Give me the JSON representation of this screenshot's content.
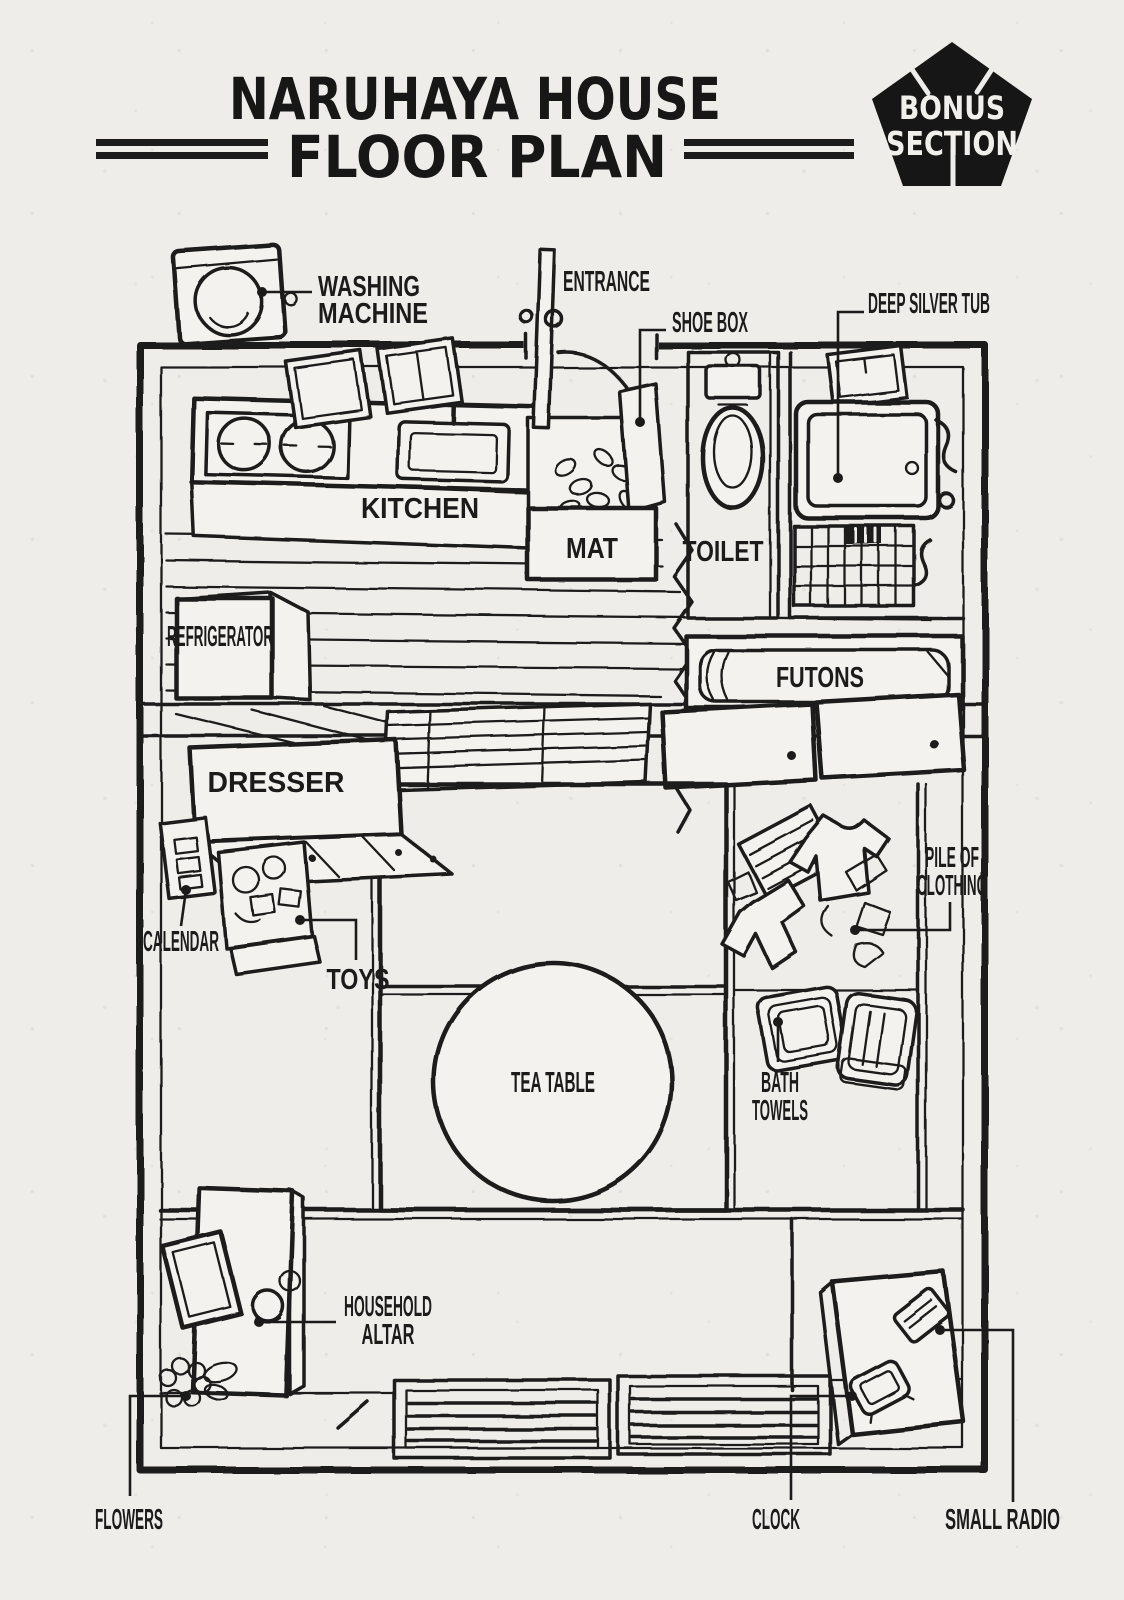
{
  "header": {
    "title_line1": "NARUHAYA HOUSE",
    "title_line2": "FLOOR PLAN"
  },
  "badge": {
    "line1": "BONUS",
    "line2": "SECTION"
  },
  "colors": {
    "ink": "#1c1c1c",
    "paper": "#efedea",
    "badge_fill": "#161616",
    "badge_text": "#f1efec"
  },
  "labels": {
    "washing_machine_1": "WASHING",
    "washing_machine_2": "MACHINE",
    "entrance": "ENTRANCE",
    "shoe_box": "SHOE BOX",
    "deep_silver_tub": "DEEP SILVER TUB",
    "kitchen": "KITCHEN",
    "mat": "MAT",
    "toilet": "TOILET",
    "refrigerator": "REFRIGERATOR",
    "futons": "FUTONS",
    "dresser": "DRESSER",
    "calendar": "CALENDAR",
    "toys": "TOYS",
    "tea_table": "TEA TABLE",
    "pile_of_clothing_1": "PILE OF",
    "pile_of_clothing_2": "CLOTHING",
    "bath_towels_1": "BATH",
    "bath_towels_2": "TOWELS",
    "household_altar_1": "HOUSEHOLD",
    "household_altar_2": "ALTAR",
    "flowers": "FLOWERS",
    "clock": "CLOCK",
    "small_radio": "SMALL RADIO"
  }
}
